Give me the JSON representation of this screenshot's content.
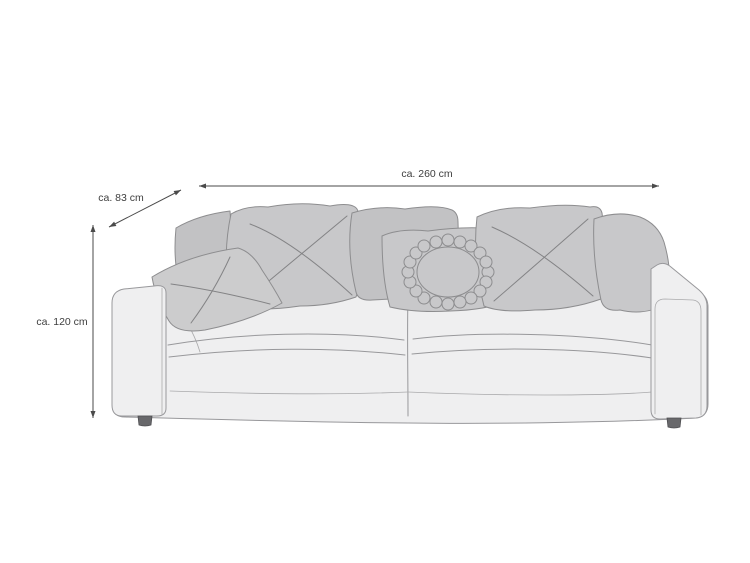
{
  "diagram": {
    "dimension_labels": {
      "width": "ca. 260 cm",
      "depth": "ca. 83 cm",
      "height": "ca. 120 cm"
    },
    "colors": {
      "background": "#ffffff",
      "sofa_body_fill": "#efeff0",
      "sofa_outline": "#98989b",
      "pillow_fill": "#c8c8ca",
      "pillow_back_fill": "#c2c2c4",
      "pillow_small_fill": "#cccccd",
      "pillow_outline": "#8d8d8f",
      "stitch_line": "#838385",
      "seam_line": "#aaaaac",
      "foot_fill": "#68686b",
      "dimension_line": "#4a4a4a",
      "label_text": "#3e3e3e"
    }
  }
}
